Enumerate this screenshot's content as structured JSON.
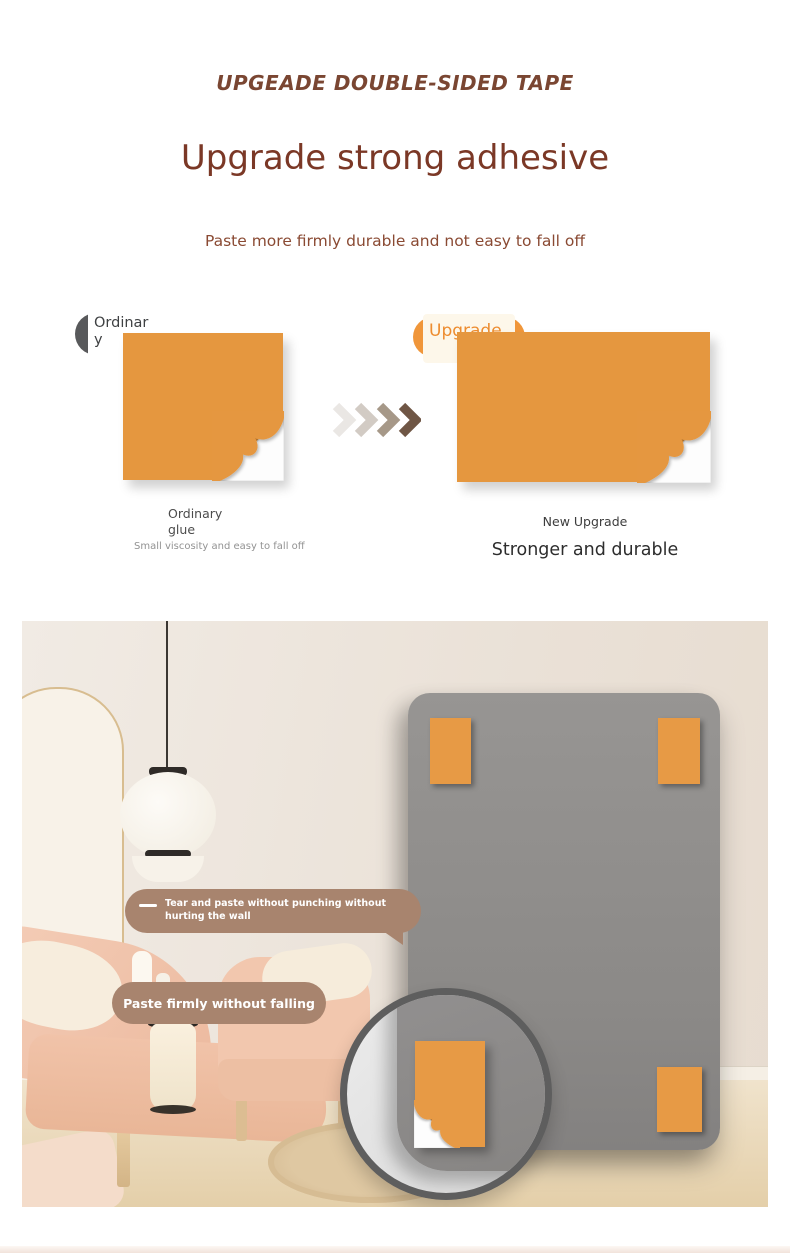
{
  "header": {
    "tagline": "UPGEADE DOUBLE-SIDED TAPE",
    "title": "Upgrade strong adhesive",
    "subtitle": "Paste more firmly durable and not easy to fall off"
  },
  "comparison": {
    "ordinary": {
      "badge": "Ordinary",
      "caption": "Ordinary glue",
      "note": "Small viscosity and easy to fall off"
    },
    "upgrade": {
      "badge": "Upgrade",
      "caption": "New Upgrade",
      "tagline": "Stronger and durable"
    },
    "arrow_colors": [
      "#EAE7E4",
      "#D2CBC4",
      "#A69888",
      "#6F5645"
    ]
  },
  "photo": {
    "bubbles": [
      {
        "text": "Tear and paste without punching without hurting the wall"
      },
      {
        "text": "Paste firmly without falling"
      }
    ]
  },
  "colors": {
    "accent_orange": "#E5973F",
    "board_tape_orange": "#E79A45",
    "heading_brown": "#7B3826",
    "tagline_brown": "#7A4632",
    "subtitle_brown": "#8A4A33",
    "bubble_tan": "#A8846E",
    "board_gray": "#8D8B89",
    "badge_dark": "#58595B",
    "badge_cream": "#FDF7EA",
    "badge_text_orange": "#ED8C2F"
  }
}
